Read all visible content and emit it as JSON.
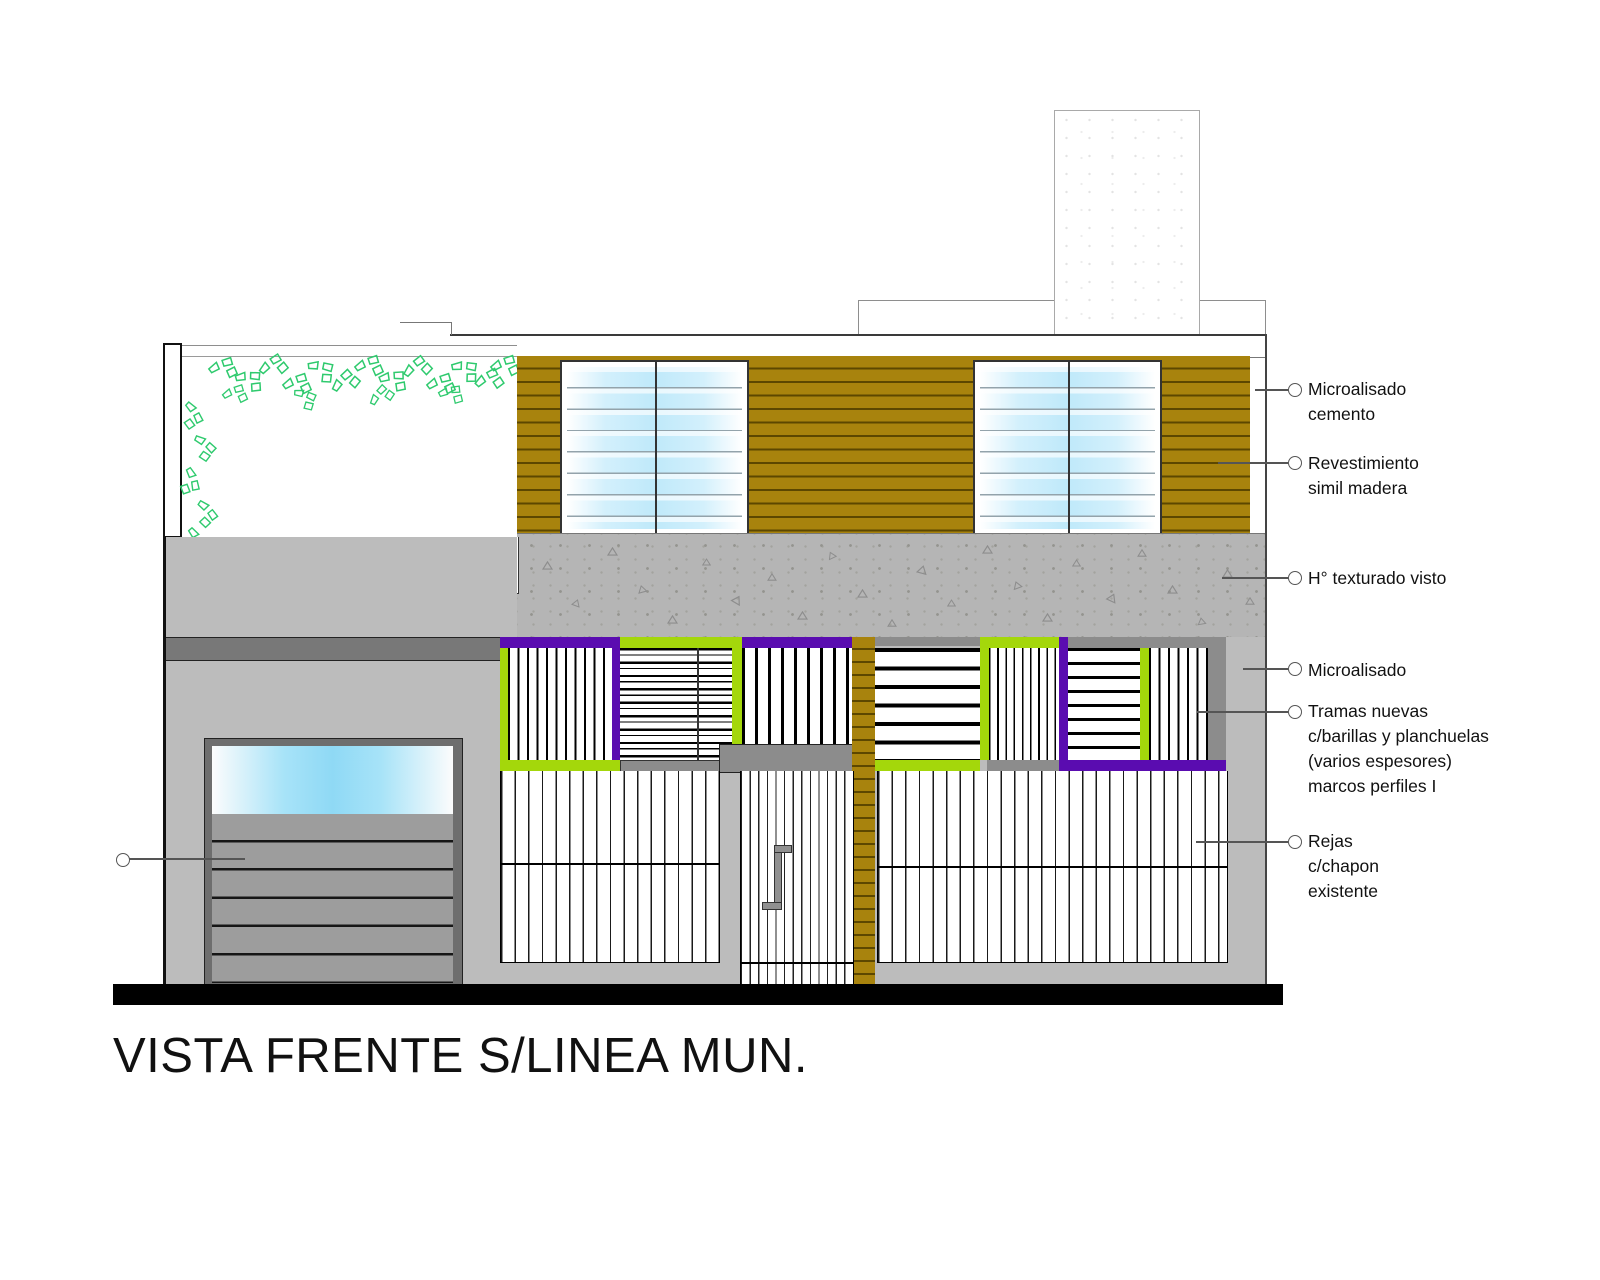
{
  "drawing": {
    "title": "VISTA FRENTE S/LINEA MUN.",
    "annotations": [
      {
        "id": "microalisado-cemento",
        "lines": [
          "Microalisado",
          "cemento"
        ]
      },
      {
        "id": "revestimiento-simil-madera",
        "lines": [
          "Revestimiento",
          "simil madera"
        ]
      },
      {
        "id": "hormigon-texturado-visto",
        "lines": [
          "H° texturado visto"
        ]
      },
      {
        "id": "microalisado",
        "lines": [
          "Microalisado"
        ]
      },
      {
        "id": "tramas-nuevas",
        "lines": [
          "Tramas nuevas",
          "c/barillas y planchuelas",
          "(varios espesores)",
          "marcos perfiles I"
        ]
      },
      {
        "id": "rejas-chapon",
        "lines": [
          "Rejas",
          "c/chapon",
          "existente"
        ]
      },
      {
        "id": "garage-leader",
        "lines": []
      }
    ],
    "colors": {
      "wood": "#a8830d",
      "wood_line": "#5c4700",
      "frame_green": "#a4d70b",
      "frame_purple": "#5a0cb0",
      "foliage": "#2fca6e",
      "wall": "#bcbcbc",
      "mid_gray": "#8c8c8c",
      "dark_stripe": "#787878",
      "texture": "#b5b5b5",
      "glass_blue": "#bfe9fa",
      "garage_glass": "#8fd9f5",
      "ground": "#000000"
    }
  }
}
